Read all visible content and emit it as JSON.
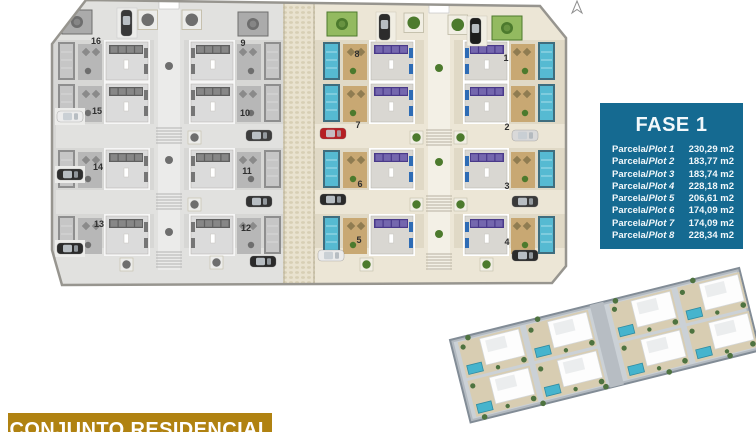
{
  "legend": {
    "title": "FASE 1",
    "rows": [
      {
        "prefix": "Parcela/",
        "name": "Plot 1",
        "area": "230,29 m2"
      },
      {
        "prefix": "Parcela/",
        "name": "Plot 2",
        "area": "183,77 m2"
      },
      {
        "prefix": "Parcela/",
        "name": "Plot 3",
        "area": "183,74 m2"
      },
      {
        "prefix": "Parcela/",
        "name": "Plot 4",
        "area": "228,18 m2"
      },
      {
        "prefix": "Parcela/",
        "name": "Plot 5",
        "area": "206,61 m2"
      },
      {
        "prefix": "Parcela/",
        "name": "Plot 6",
        "area": "174,09 m2"
      },
      {
        "prefix": "Parcela/",
        "name": "Plot 7",
        "area": "174,09 m2"
      },
      {
        "prefix": "Parcela/",
        "name": "Plot 8",
        "area": "228,34 m2"
      }
    ]
  },
  "banner": {
    "text": "CONJUNTO RESIDENCIAL"
  },
  "siteplan": {
    "phase_gray": {
      "plots": [
        {
          "n": "16",
          "x": 96,
          "y": 44
        },
        {
          "n": "9",
          "x": 243,
          "y": 46
        },
        {
          "n": "15",
          "x": 97,
          "y": 114
        },
        {
          "n": "10",
          "x": 245,
          "y": 116
        },
        {
          "n": "14",
          "x": 98,
          "y": 170
        },
        {
          "n": "11",
          "x": 247,
          "y": 174
        },
        {
          "n": "13",
          "x": 99,
          "y": 227
        },
        {
          "n": "12",
          "x": 246,
          "y": 231
        }
      ]
    },
    "phase_colored": {
      "plots": [
        {
          "n": "8",
          "x": 357,
          "y": 57
        },
        {
          "n": "1",
          "x": 506,
          "y": 61
        },
        {
          "n": "7",
          "x": 358,
          "y": 128
        },
        {
          "n": "2",
          "x": 507,
          "y": 130
        },
        {
          "n": "6",
          "x": 360,
          "y": 187
        },
        {
          "n": "3",
          "x": 507,
          "y": 189
        },
        {
          "n": "5",
          "x": 359,
          "y": 243
        },
        {
          "n": "4",
          "x": 507,
          "y": 245
        }
      ]
    }
  },
  "palette": {
    "legend-bg": "#156a91",
    "banner-bg": "#b08211",
    "car-red": "#b51f23",
    "plan-stroke": "#97958f",
    "cobble": "#e9e2cf"
  },
  "palette_gray": {
    "ground": "#d7d7d5",
    "road": "#e1e1df",
    "pool": "#c6c6c6",
    "pool-frame": "#8e8e8e",
    "pool-light": "#d8d8d8",
    "terrace": "#b7b7b7",
    "chair": "#8a8a8a",
    "roof": "#dbdbdb",
    "roof-trim": "#f6f6f6",
    "panel": "#5f5f5f",
    "panel-cell": "#878787",
    "lounger": "#767676",
    "green": "#ababab",
    "green-dark": "#6e6e6e",
    "stair": "#b3b3b3",
    "pad": "#ececea"
  },
  "palette_color": {
    "ground": "#e0d9c6",
    "road": "#ece6d6",
    "pool": "#56bad2",
    "pool-frame": "#3f6d7e",
    "pool-light": "#a8dde9",
    "terrace": "#c8a873",
    "chair": "#8f7c51",
    "roof": "#d9d7d2",
    "roof-trim": "#ffffff",
    "panel": "#49398a",
    "panel-cell": "#7467ae",
    "lounger": "#2e6cb5",
    "green": "#93ba60",
    "green-dark": "#4c7a2d",
    "stair": "#b7b1a2",
    "pad": "#f1eee3"
  },
  "palette_render": {
    "platform": "#b2b9c0",
    "platform-edge": "#828c96",
    "ground3d": "#cbd1d6",
    "road3d": "#b7bdc3",
    "sand": "#d8cdb2",
    "house": "#fdfdfd",
    "house-edge": "#d5d8da",
    "house-shade": "#ebedee",
    "pool3d": "#46b4cd",
    "pool3d-edge": "#2f8ba2",
    "tree3d": "#4e7340"
  }
}
